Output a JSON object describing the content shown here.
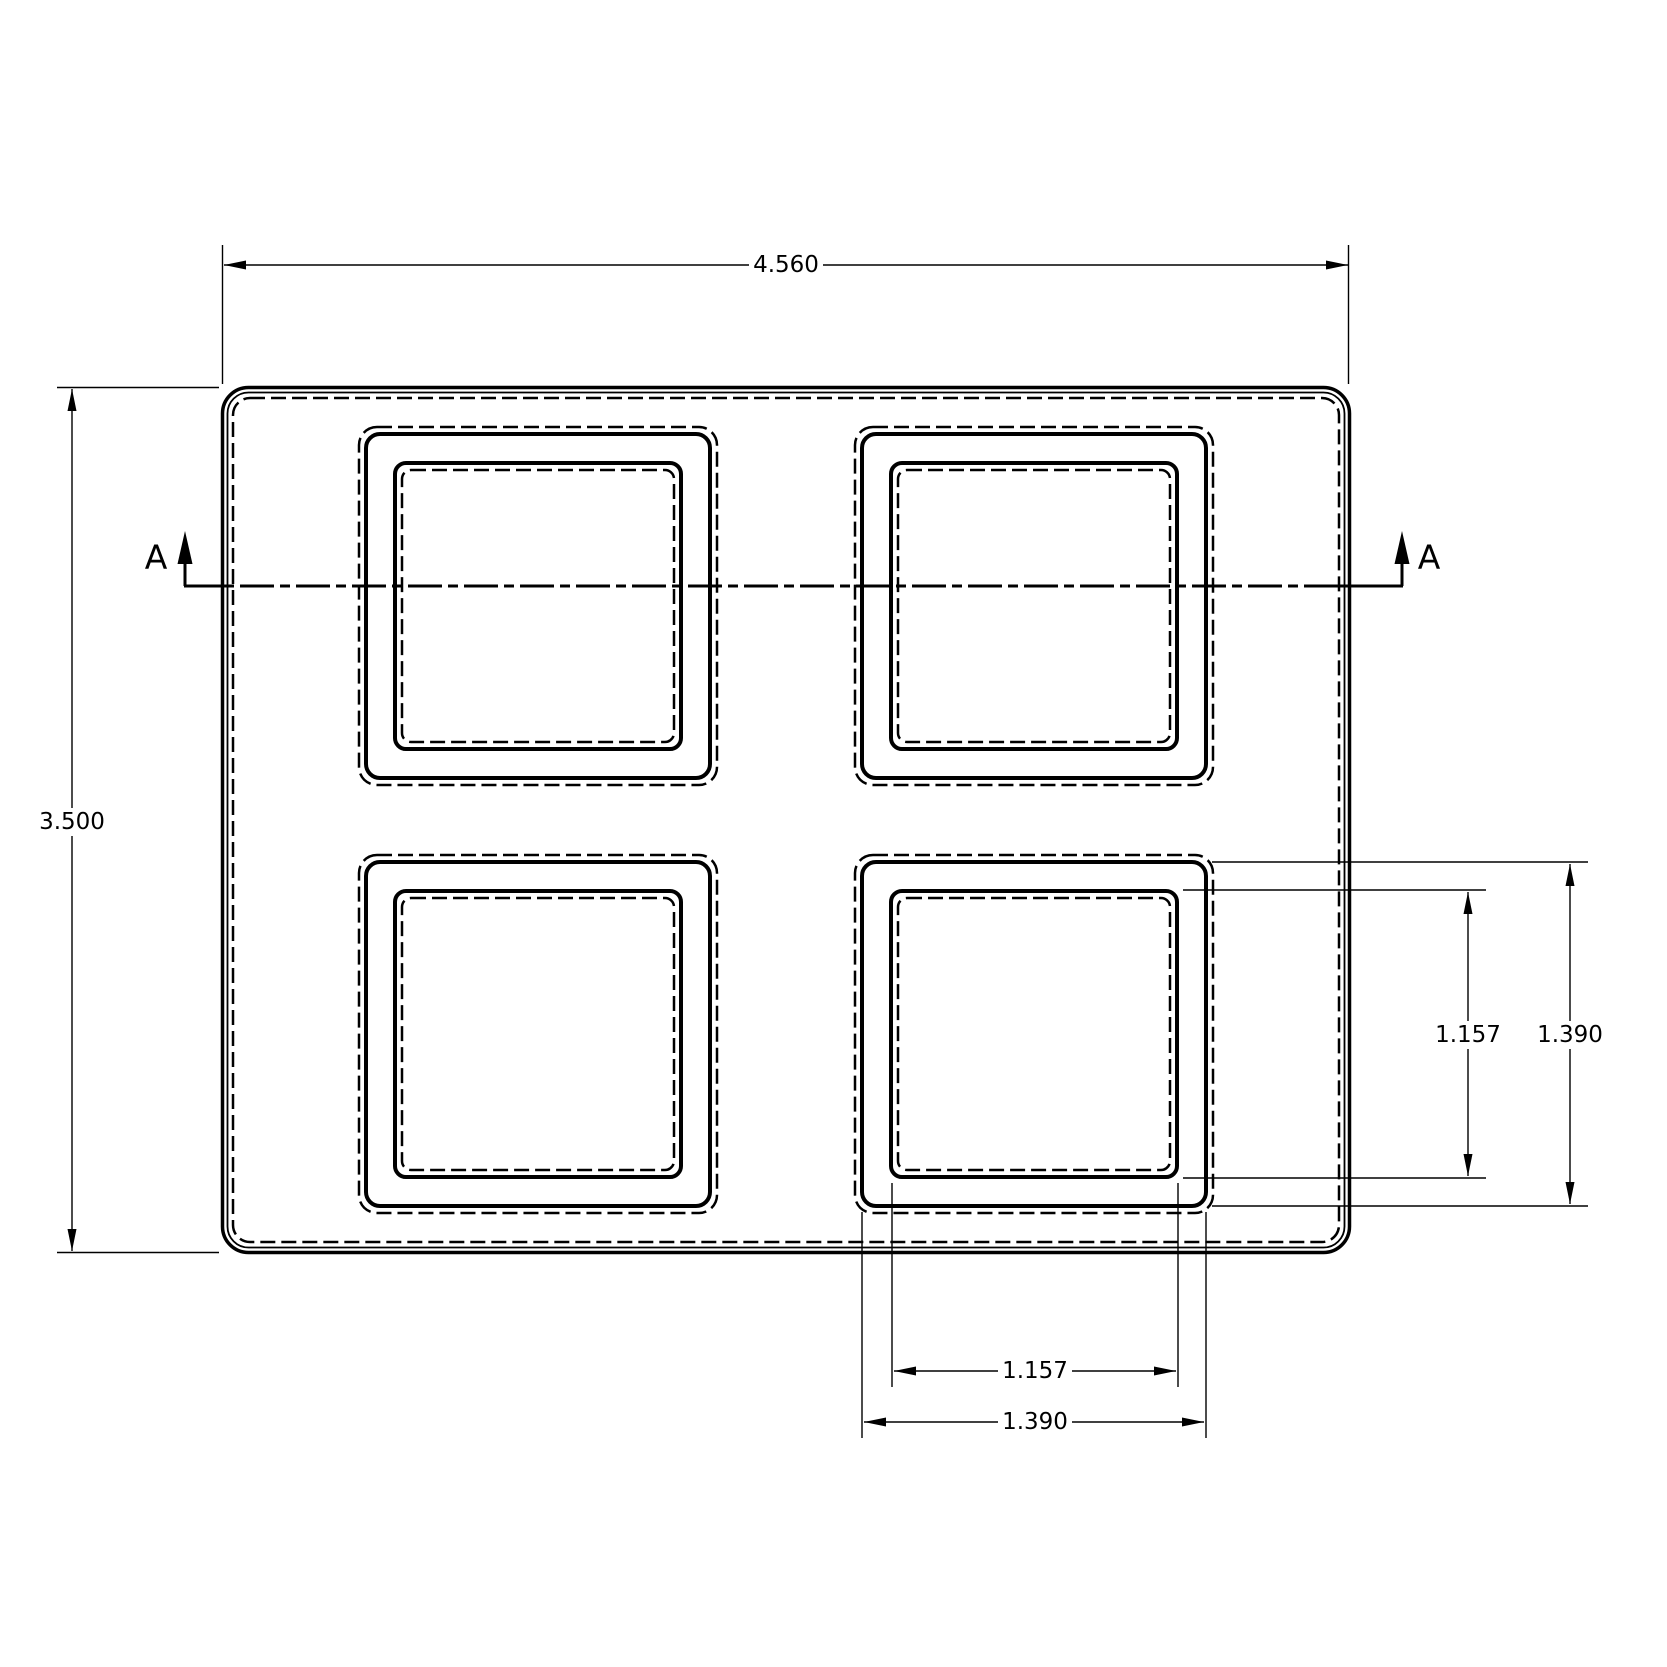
{
  "drawing": {
    "background_color": "#ffffff",
    "line_color": "#000000",
    "view": "top-view-tray-with-4-square-pockets",
    "section": {
      "left_label": "A",
      "right_label": "A"
    },
    "dims": {
      "overall_width": "4.560",
      "overall_height": "3.500",
      "pocket_opening_height": "1.157",
      "pocket_outer_height": "1.390",
      "pocket_opening_width": "1.157",
      "pocket_outer_width": "1.390"
    }
  }
}
